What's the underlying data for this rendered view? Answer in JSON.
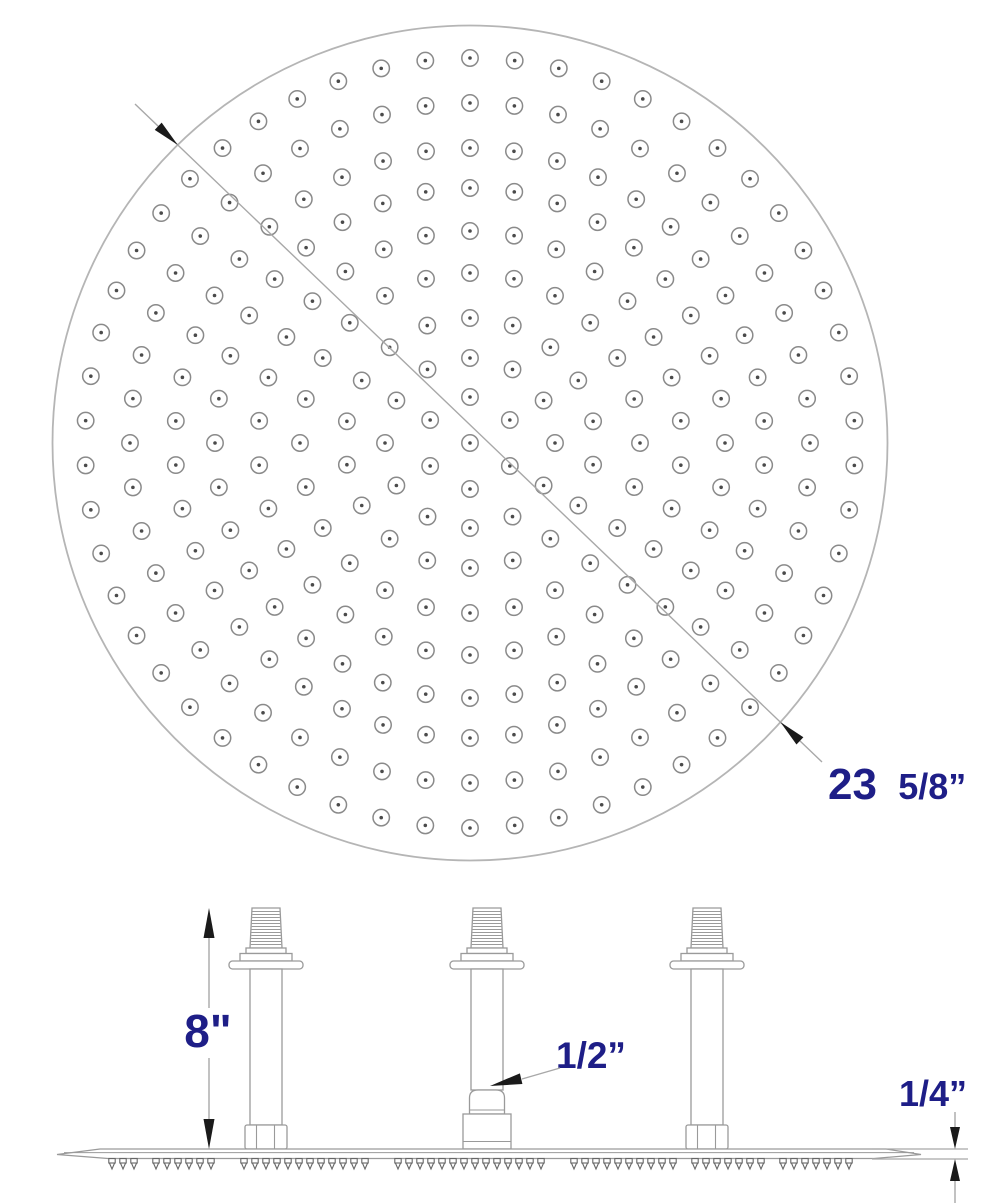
{
  "colors": {
    "accent": "#1e1e87",
    "line": "#9a9a9a",
    "rim": "#b5b5b5",
    "nozzle_ring": "#8a8a8a",
    "nozzle_dot": "#4a4a4a",
    "dim_line": "#a8a8a8",
    "arrow": "#1a1a1a",
    "tooth": "#666666"
  },
  "top_view": {
    "diameter_label": {
      "whole": "23",
      "fraction": "5/8”"
    },
    "nozzle_pattern": {
      "center": true,
      "rings": [
        {
          "r": 46,
          "count": 6
        },
        {
          "r": 85,
          "count": 12
        },
        {
          "r": 125,
          "count": 18
        },
        {
          "r": 170,
          "count": 24
        },
        {
          "r": 212,
          "count": 30
        },
        {
          "r": 255,
          "count": 36
        },
        {
          "r": 295,
          "count": 42
        },
        {
          "r": 340,
          "count": 48
        },
        {
          "r": 385,
          "count": 54
        }
      ]
    }
  },
  "bottom_view": {
    "height_label": "8\"",
    "connector_label": "1/2”",
    "thickness_label": "1/4”"
  }
}
